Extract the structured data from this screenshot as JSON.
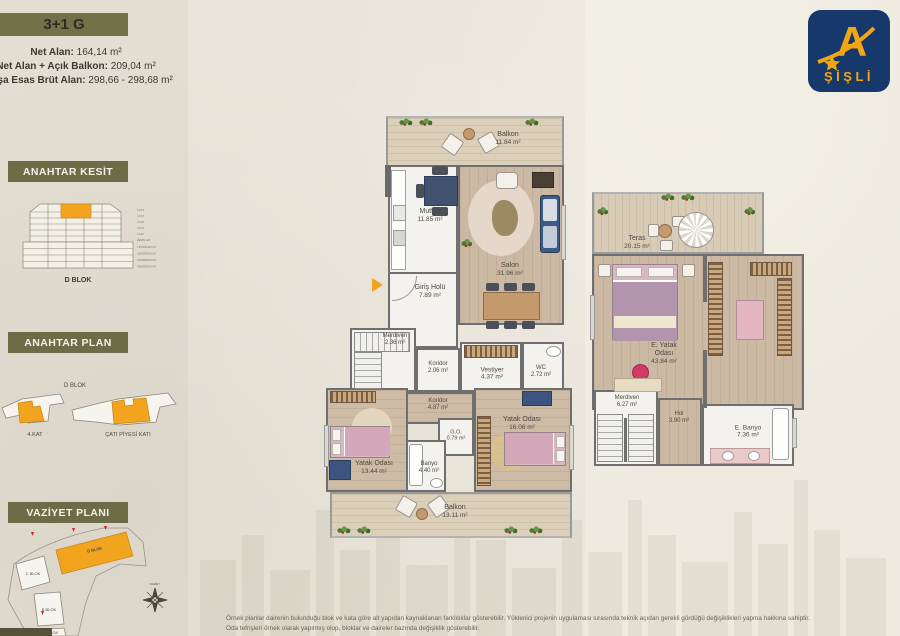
{
  "unit": {
    "title": "3+1 G"
  },
  "sidebar": {
    "stats": [
      {
        "label": "Net Alan:",
        "value": " 164,14 m²"
      },
      {
        "label": "Net Alan + Açık Balkon:",
        "value": " 209,04 m²"
      },
      {
        "label": "Satışa Esas Brüt Alan:",
        "value": " 298,66 - 298,68 m²"
      }
    ],
    "kesit": {
      "title": "ANAHTAR KESİT",
      "block_label": "D BLOK",
      "floor_labels": [
        "5.KAT",
        "4.KAT",
        "3.KAT",
        "2.KAT",
        "1.KAT",
        "ZEMİN KAT",
        "1.BODRUM KAT",
        "2.BODRUM KAT",
        "3.BODRUM KAT",
        "4.BODRUM KAT"
      ]
    },
    "plan": {
      "title": "ANAHTAR PLAN",
      "block_label": "D BLOK",
      "floors": [
        "4.KAT",
        "ÇATI PİYESİ KATI"
      ]
    },
    "vaziyet": {
      "title": "VAZİYET PLANI",
      "blocks": [
        "C BLOK",
        "D BLOK",
        "B BLOK",
        "A BLOK"
      ],
      "highlighted_block": "D BLOK"
    }
  },
  "logo": {
    "letter": "A",
    "name": "ŞİŞLİ"
  },
  "floorplans": {
    "main_floor": {
      "rooms": [
        {
          "name": "Balkon",
          "area": "11.84 m²"
        },
        {
          "name": "Mutfak",
          "area": "11.85 m²"
        },
        {
          "name": "Salon",
          "area": "31.96 m²"
        },
        {
          "name": "Giriş Holü",
          "area": "7.89 m²"
        },
        {
          "name": "Merdiven",
          "area": "2.36 m²"
        },
        {
          "name": "Koridor",
          "area": "2.06 m²"
        },
        {
          "name": "Vestiyer",
          "area": "4.37 m²"
        },
        {
          "name": "WC",
          "area": "2.72 m²"
        },
        {
          "name": "Koridor",
          "area": "4.87 m²"
        },
        {
          "name": "Yatak Odası",
          "area": "13.44 m²"
        },
        {
          "name": "G.O.",
          "area": "0.79 m²"
        },
        {
          "name": "Banyo",
          "area": "4.40 m²"
        },
        {
          "name": "Yatak Odası",
          "area": "16.06 m²"
        },
        {
          "name": "Balkon",
          "area": "13.11 m²"
        }
      ]
    },
    "roof_floor": {
      "rooms": [
        {
          "name": "Teras",
          "area": "20.15 m²"
        },
        {
          "name": "E. Yatak Odası",
          "area": "43.84 m²"
        },
        {
          "name": "Merdiven",
          "area": "6.27 m²"
        },
        {
          "name": "Hol",
          "area": "3.90 m²"
        },
        {
          "name": "E. Banyo",
          "area": "7.36 m²"
        }
      ]
    }
  },
  "footer": {
    "line1": "Örnek planlar dairenin bulunduğu blok ve kata göre alt yapıdan kaynaklanan farklılıklar gösterebilir. Yüklenici projenin uygulaması sırasında teknik açıdan gerekli gördüğü değişiklikleri yapma hakkına sahiptir.",
    "line2": "Oda tefrişleri örnek olarak yapılmış olup, bloklar ve daireler bazında değişiklik gösterebilir."
  },
  "colors": {
    "accent_orange": "#f2a41f",
    "olive": "#6d6c47",
    "logo_blue": "#16386b",
    "logo_gold": "#f0a713",
    "wall_gray": "#6f6f6f"
  }
}
